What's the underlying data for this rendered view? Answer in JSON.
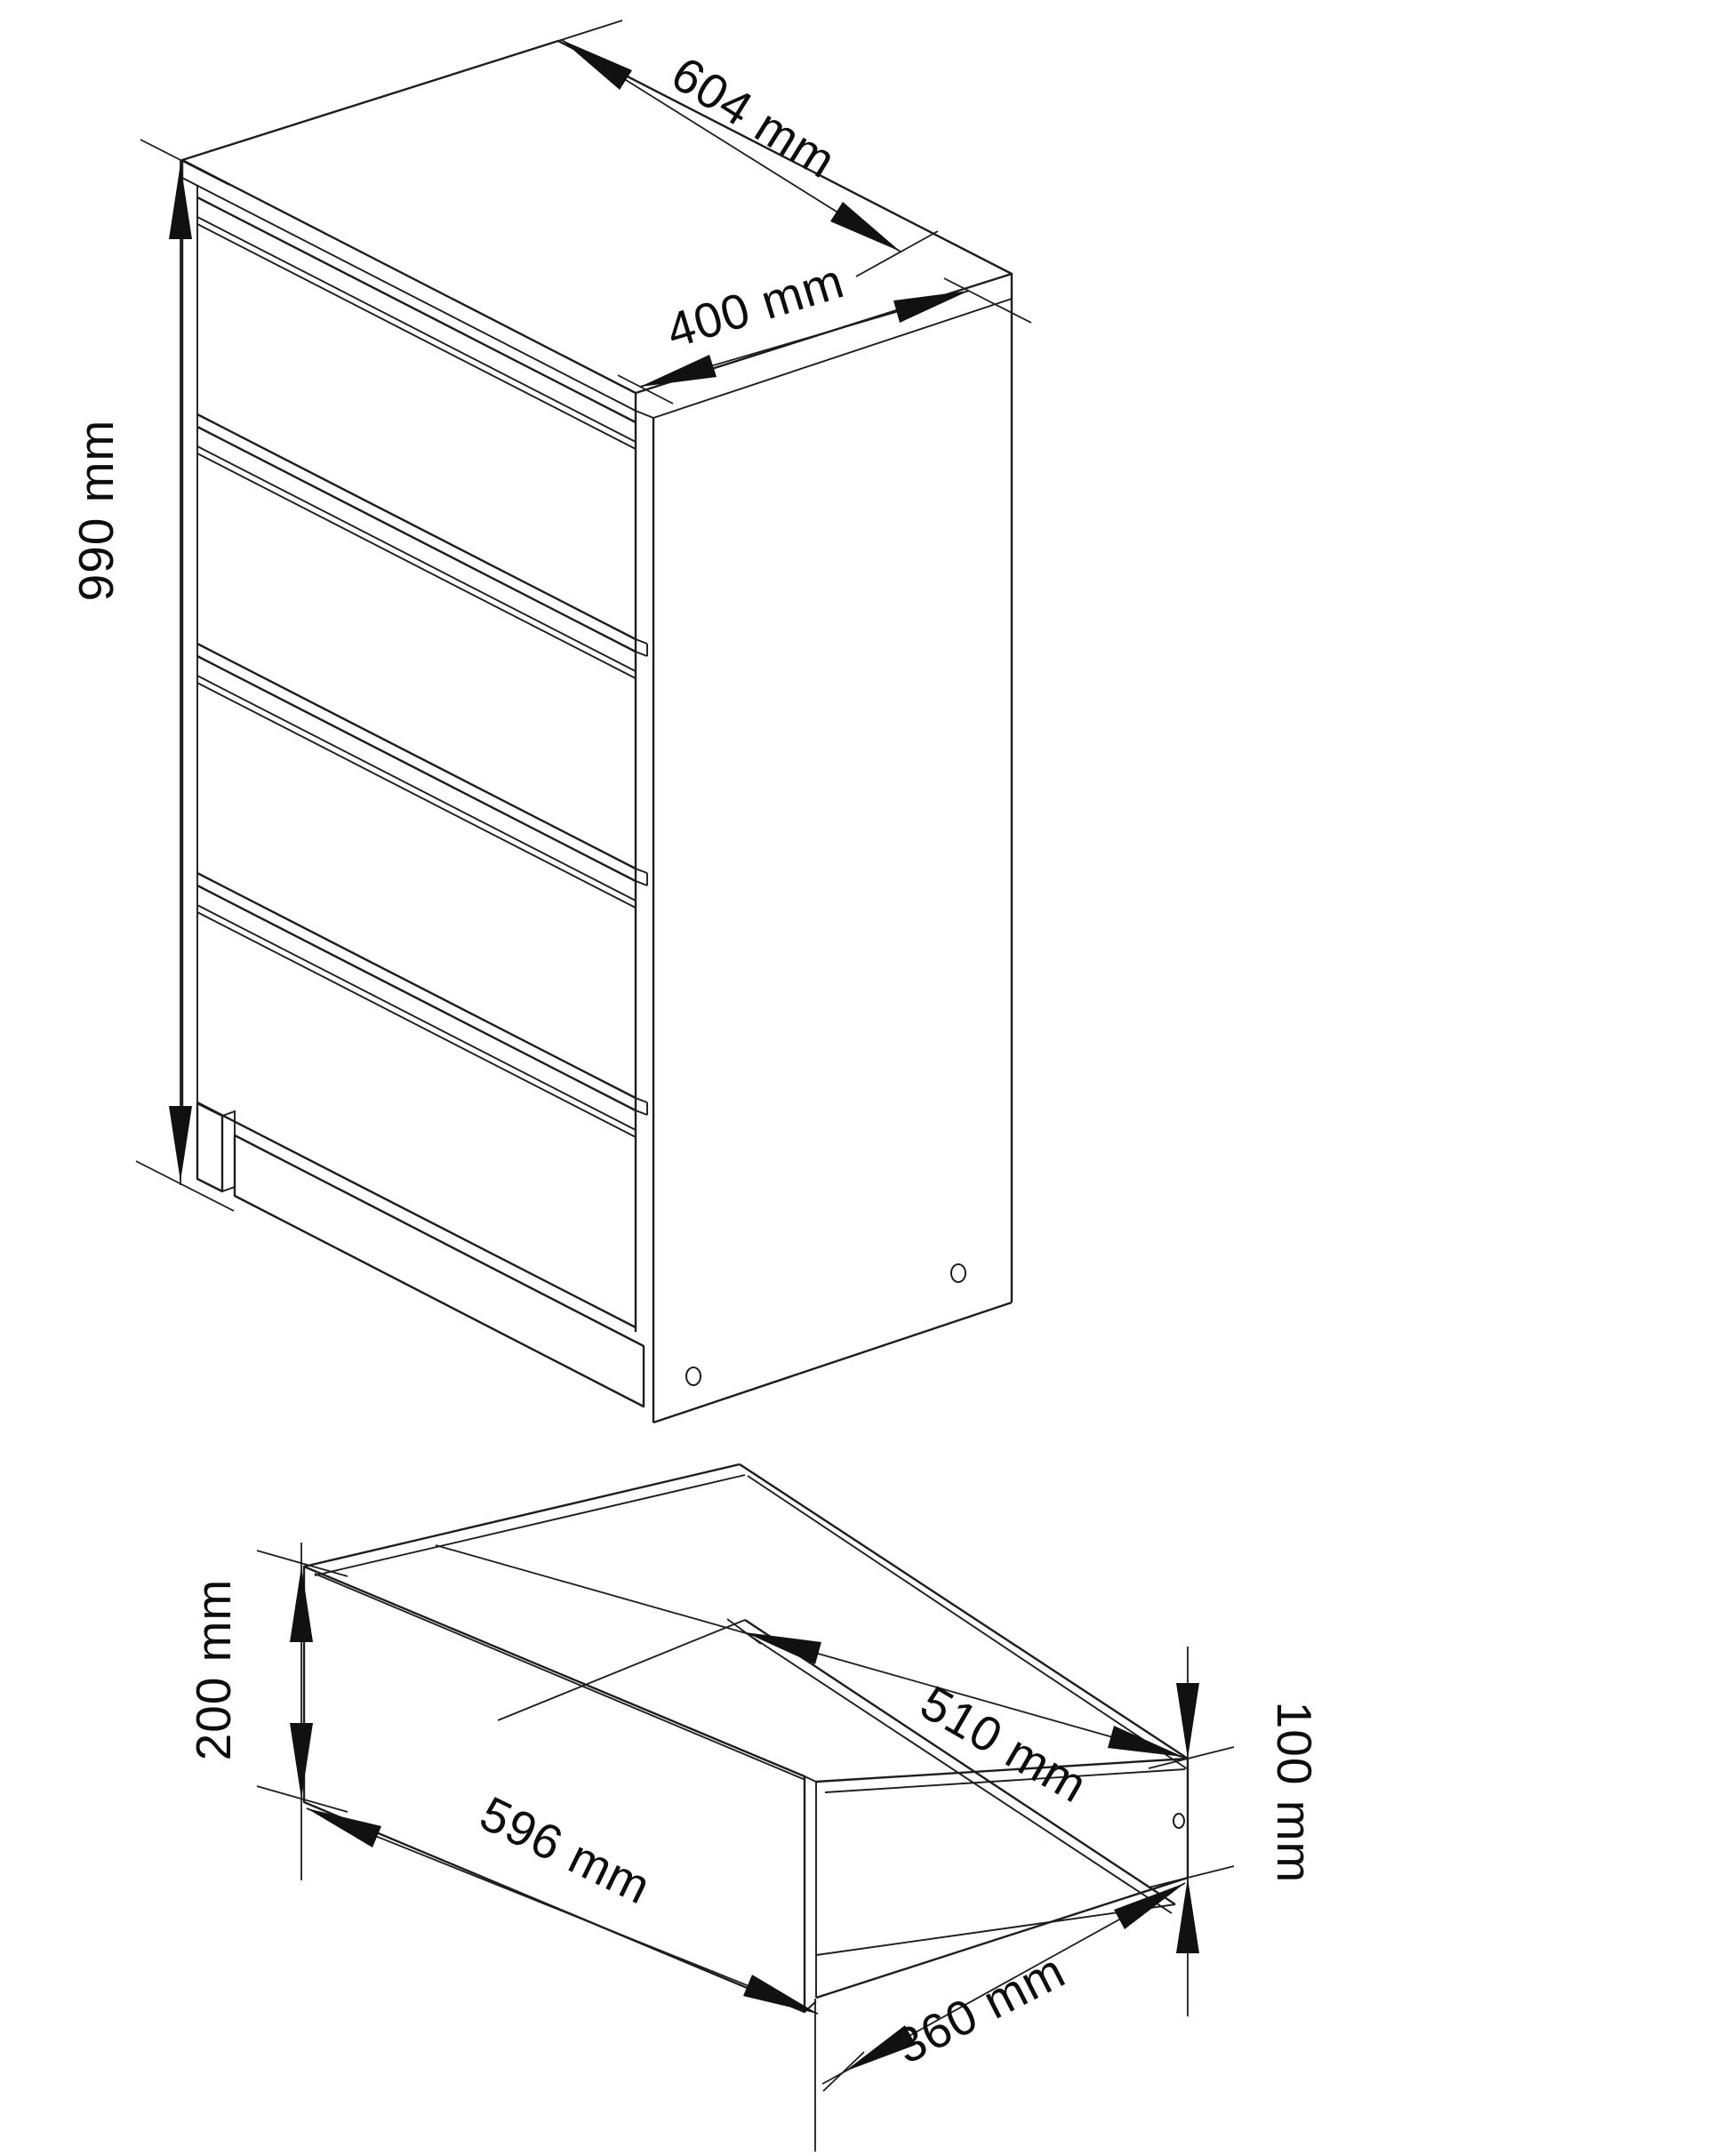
{
  "drawing": {
    "kind": "furniture dimension diagram",
    "views": {
      "cabinet": {
        "description": "chest of drawers with 4 drawer fronts, isometric view",
        "drawer_count": 4,
        "dimensions": {
          "width_label": "604 mm",
          "depth_label": "400 mm",
          "height_label": "990 mm"
        },
        "side_panel_holes": 2
      },
      "drawer": {
        "description": "single open drawer, isometric view",
        "dimensions": {
          "front_height_label": "200 mm",
          "front_width_label": "596 mm",
          "side_length_label": "510 mm",
          "bottom_depth_label": "360 mm",
          "side_height_label": "100 mm"
        },
        "side_panel_holes": 1
      }
    },
    "colors": {
      "background": "#ffffff",
      "line": "#1d1d1d",
      "text": "#0d0d0d"
    }
  }
}
